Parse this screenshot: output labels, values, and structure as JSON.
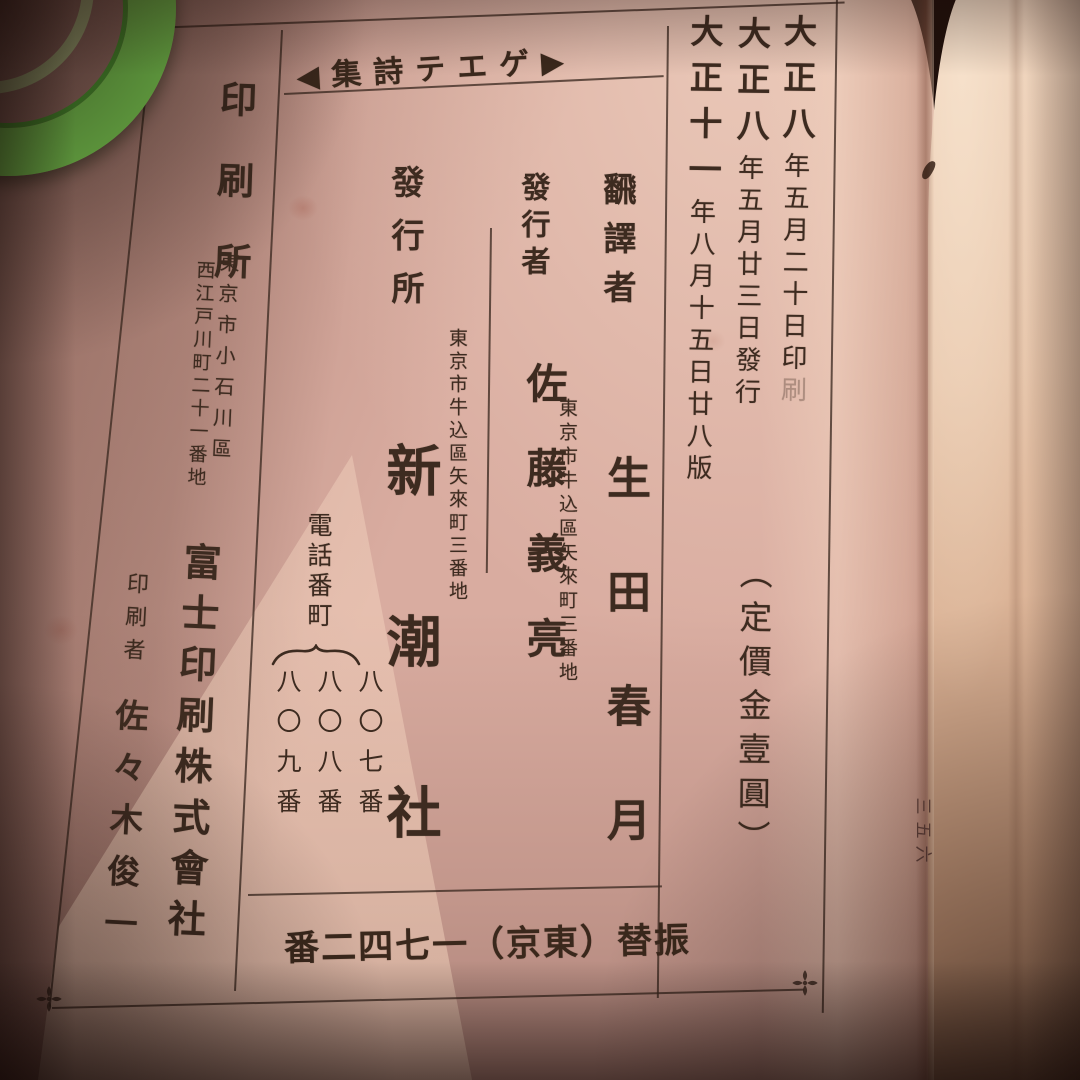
{
  "photo": {
    "edge_page_number": "三五六"
  },
  "colors": {
    "paper": "#d9aca0",
    "next_page_paper": "#e6c4a9",
    "ink": "#3d2b20",
    "green_object": "#7fd355",
    "background": "#1f100b"
  },
  "colophon": {
    "header": "◀集詩テエゲ▶",
    "dates": [
      {
        "era": "大正八",
        "date": "年五月二十日",
        "suffix": "印",
        "suffix_faint": "刷"
      },
      {
        "era": "大正八",
        "date": "年五月廿三日",
        "suffix": "發行",
        "suffix_faint": ""
      },
      {
        "era": "大正十一",
        "date": "年八月十五日",
        "suffix": "廿八版",
        "suffix_faint": ""
      }
    ],
    "price": "︵定價金壹圓︶",
    "translator": {
      "label": "飜譯者",
      "name": "生田春月",
      "address": "東京市牛込區矢來町三番地"
    },
    "publisher_person": {
      "label": "發行者",
      "name": "佐藤義亮"
    },
    "publisher_house": {
      "label": "發行所",
      "name": "新潮社",
      "address": "東京市牛込區矢來町三番地",
      "phone_label": "電話番町",
      "phone_numbers": [
        "八〇七番",
        "八〇八番",
        "八〇九番"
      ]
    },
    "printer": {
      "label": "印刷所",
      "address1": "東京市小石川區",
      "address2": "西江戸川町二十一番地",
      "company": "富士印刷株式會社",
      "person_label": "印刷者",
      "person_name": "佐々木俊一"
    },
    "transfer": "番二四七一（京東）替振"
  }
}
